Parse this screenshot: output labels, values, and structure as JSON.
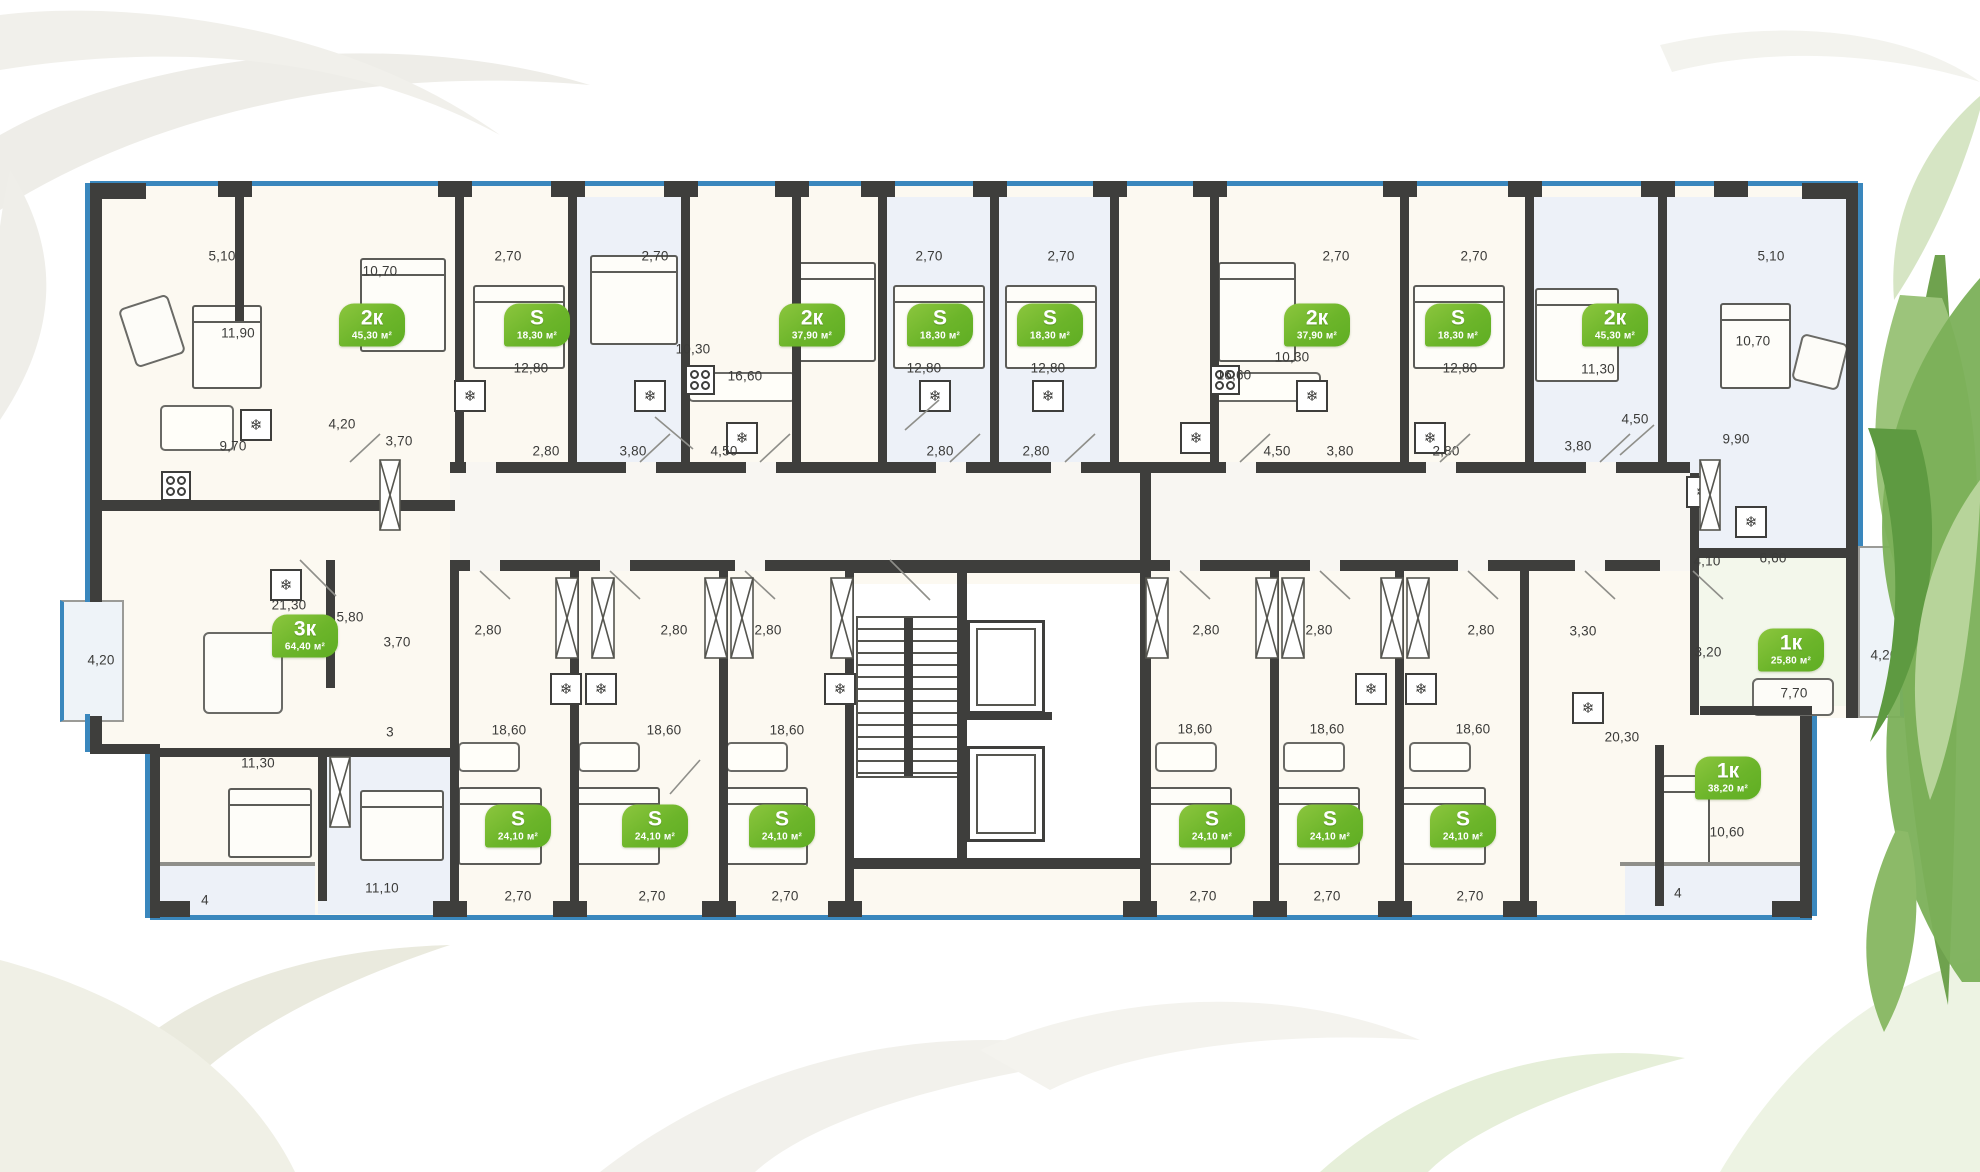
{
  "legend": {
    "badge_type_2room": "2к",
    "badge_type_3room": "3к",
    "badge_type_1room": "1к",
    "badge_type_studio": "S"
  },
  "colors": {
    "badge_green_light": "#8cc63e",
    "badge_green_dark": "#5fae23",
    "wall_dark": "#3e3e3c",
    "glazing_blue": "#3a87bd",
    "room_warm": "#fcf9f1",
    "room_blue": "#edf1f8",
    "room_green": "#f3f7eb"
  },
  "badges": [
    {
      "t": "2к",
      "a": "45,30 м²",
      "x": 372,
      "y": 325
    },
    {
      "t": "S",
      "a": "18,30 м²",
      "x": 537,
      "y": 325
    },
    {
      "t": "2к",
      "a": "37,90 м²",
      "x": 812,
      "y": 325
    },
    {
      "t": "S",
      "a": "18,30 м²",
      "x": 940,
      "y": 325
    },
    {
      "t": "S",
      "a": "18,30 м²",
      "x": 1050,
      "y": 325
    },
    {
      "t": "2к",
      "a": "37,90 м²",
      "x": 1317,
      "y": 325
    },
    {
      "t": "S",
      "a": "18,30 м²",
      "x": 1458,
      "y": 325
    },
    {
      "t": "2к",
      "a": "45,30 м²",
      "x": 1615,
      "y": 325
    },
    {
      "t": "3к",
      "a": "64,40 м²",
      "x": 305,
      "y": 636
    },
    {
      "t": "S",
      "a": "24,10 м²",
      "x": 518,
      "y": 826
    },
    {
      "t": "S",
      "a": "24,10 м²",
      "x": 655,
      "y": 826
    },
    {
      "t": "S",
      "a": "24,10 м²",
      "x": 782,
      "y": 826
    },
    {
      "t": "S",
      "a": "24,10 м²",
      "x": 1212,
      "y": 826
    },
    {
      "t": "S",
      "a": "24,10 м²",
      "x": 1330,
      "y": 826
    },
    {
      "t": "S",
      "a": "24,10 м²",
      "x": 1463,
      "y": 826
    },
    {
      "t": "1к",
      "a": "25,80 м²",
      "x": 1791,
      "y": 650
    },
    {
      "t": "1к",
      "a": "38,20 м²",
      "x": 1728,
      "y": 778
    }
  ],
  "dims": [
    {
      "t": "5,10",
      "x": 222,
      "y": 256
    },
    {
      "t": "10,70",
      "x": 380,
      "y": 271
    },
    {
      "t": "2,70",
      "x": 508,
      "y": 256
    },
    {
      "t": "2,70",
      "x": 655,
      "y": 256
    },
    {
      "t": "2,70",
      "x": 929,
      "y": 256
    },
    {
      "t": "2,70",
      "x": 1061,
      "y": 256
    },
    {
      "t": "2,70",
      "x": 1336,
      "y": 256
    },
    {
      "t": "2,70",
      "x": 1474,
      "y": 256
    },
    {
      "t": "5,10",
      "x": 1771,
      "y": 256
    },
    {
      "t": "10,70",
      "x": 1753,
      "y": 341
    },
    {
      "t": "11,90",
      "x": 238,
      "y": 333
    },
    {
      "t": "10,30",
      "x": 693,
      "y": 349
    },
    {
      "t": "10,30",
      "x": 1292,
      "y": 357
    },
    {
      "t": "11,30",
      "x": 1598,
      "y": 369
    },
    {
      "t": "12,80",
      "x": 531,
      "y": 368
    },
    {
      "t": "12,80",
      "x": 924,
      "y": 368
    },
    {
      "t": "12,80",
      "x": 1048,
      "y": 368
    },
    {
      "t": "12,80",
      "x": 1460,
      "y": 368
    },
    {
      "t": "16,60",
      "x": 745,
      "y": 376
    },
    {
      "t": "16,60",
      "x": 1234,
      "y": 375
    },
    {
      "t": "9,70",
      "x": 233,
      "y": 446
    },
    {
      "t": "4,20",
      "x": 342,
      "y": 424
    },
    {
      "t": "3,70",
      "x": 399,
      "y": 441
    },
    {
      "t": "2,80",
      "x": 546,
      "y": 451
    },
    {
      "t": "3,80",
      "x": 633,
      "y": 451
    },
    {
      "t": "4,50",
      "x": 724,
      "y": 451
    },
    {
      "t": "2,80",
      "x": 940,
      "y": 451
    },
    {
      "t": "2,80",
      "x": 1036,
      "y": 451
    },
    {
      "t": "4,50",
      "x": 1277,
      "y": 451
    },
    {
      "t": "3,80",
      "x": 1340,
      "y": 451
    },
    {
      "t": "2,80",
      "x": 1446,
      "y": 451
    },
    {
      "t": "3,80",
      "x": 1578,
      "y": 446
    },
    {
      "t": "4,50",
      "x": 1635,
      "y": 419
    },
    {
      "t": "9,90",
      "x": 1736,
      "y": 439
    },
    {
      "t": "4,10",
      "x": 1707,
      "y": 561
    },
    {
      "t": "6,60",
      "x": 1773,
      "y": 558
    },
    {
      "t": "3,20",
      "x": 1708,
      "y": 652
    },
    {
      "t": "3,30",
      "x": 1583,
      "y": 631
    },
    {
      "t": "21,30",
      "x": 289,
      "y": 605
    },
    {
      "t": "5,80",
      "x": 350,
      "y": 617
    },
    {
      "t": "3,70",
      "x": 397,
      "y": 642
    },
    {
      "t": "4,20",
      "x": 101,
      "y": 660
    },
    {
      "t": "3",
      "x": 390,
      "y": 732
    },
    {
      "t": "11,30",
      "x": 258,
      "y": 763
    },
    {
      "t": "11,10",
      "x": 382,
      "y": 888
    },
    {
      "t": "4",
      "x": 205,
      "y": 900
    },
    {
      "t": "2,80",
      "x": 488,
      "y": 630
    },
    {
      "t": "2,80",
      "x": 674,
      "y": 630
    },
    {
      "t": "2,80",
      "x": 768,
      "y": 630
    },
    {
      "t": "2,80",
      "x": 1206,
      "y": 630
    },
    {
      "t": "2,80",
      "x": 1319,
      "y": 630
    },
    {
      "t": "2,80",
      "x": 1481,
      "y": 630
    },
    {
      "t": "18,60",
      "x": 509,
      "y": 730
    },
    {
      "t": "18,60",
      "x": 664,
      "y": 730
    },
    {
      "t": "18,60",
      "x": 787,
      "y": 730
    },
    {
      "t": "18,60",
      "x": 1195,
      "y": 729
    },
    {
      "t": "18,60",
      "x": 1327,
      "y": 729
    },
    {
      "t": "18,60",
      "x": 1473,
      "y": 729
    },
    {
      "t": "2,70",
      "x": 518,
      "y": 896
    },
    {
      "t": "2,70",
      "x": 652,
      "y": 896
    },
    {
      "t": "2,70",
      "x": 785,
      "y": 896
    },
    {
      "t": "2,70",
      "x": 1203,
      "y": 896
    },
    {
      "t": "2,70",
      "x": 1327,
      "y": 896
    },
    {
      "t": "2,70",
      "x": 1470,
      "y": 896
    },
    {
      "t": "20,30",
      "x": 1622,
      "y": 737
    },
    {
      "t": "10,60",
      "x": 1727,
      "y": 832
    },
    {
      "t": "7,70",
      "x": 1794,
      "y": 693
    },
    {
      "t": "4,20",
      "x": 1884,
      "y": 655
    },
    {
      "t": "4",
      "x": 1678,
      "y": 893
    }
  ],
  "icons": [
    {
      "n": "fridge-icon",
      "g": "❄",
      "x": 256,
      "y": 425
    },
    {
      "n": "fridge-icon",
      "g": "❄",
      "x": 470,
      "y": 396
    },
    {
      "n": "fridge-icon",
      "g": "❄",
      "x": 650,
      "y": 396
    },
    {
      "n": "fridge-icon",
      "g": "❄",
      "x": 742,
      "y": 438
    },
    {
      "n": "fridge-icon",
      "g": "❄",
      "x": 935,
      "y": 396
    },
    {
      "n": "fridge-icon",
      "g": "❄",
      "x": 1048,
      "y": 396
    },
    {
      "n": "fridge-icon",
      "g": "❄",
      "x": 1196,
      "y": 438
    },
    {
      "n": "fridge-icon",
      "g": "❄",
      "x": 1312,
      "y": 396
    },
    {
      "n": "fridge-icon",
      "g": "❄",
      "x": 1430,
      "y": 438
    },
    {
      "n": "fridge-icon",
      "g": "❄",
      "x": 286,
      "y": 585
    },
    {
      "n": "fridge-icon",
      "g": "❄",
      "x": 566,
      "y": 689
    },
    {
      "n": "fridge-icon",
      "g": "❄",
      "x": 601,
      "y": 689
    },
    {
      "n": "fridge-icon",
      "g": "❄",
      "x": 840,
      "y": 689
    },
    {
      "n": "fridge-icon",
      "g": "❄",
      "x": 1371,
      "y": 689
    },
    {
      "n": "fridge-icon",
      "g": "❄",
      "x": 1421,
      "y": 689
    },
    {
      "n": "fridge-icon",
      "g": "❄",
      "x": 1588,
      "y": 708
    },
    {
      "n": "fridge-icon",
      "g": "❄",
      "x": 1751,
      "y": 522
    },
    {
      "n": "fridge-icon",
      "g": "❄",
      "x": 1702,
      "y": 492
    }
  ],
  "stoves": [
    {
      "n": "stove-icon",
      "x": 176,
      "y": 486
    },
    {
      "n": "stove-icon",
      "x": 700,
      "y": 380
    },
    {
      "n": "stove-icon",
      "x": 1225,
      "y": 380
    }
  ]
}
